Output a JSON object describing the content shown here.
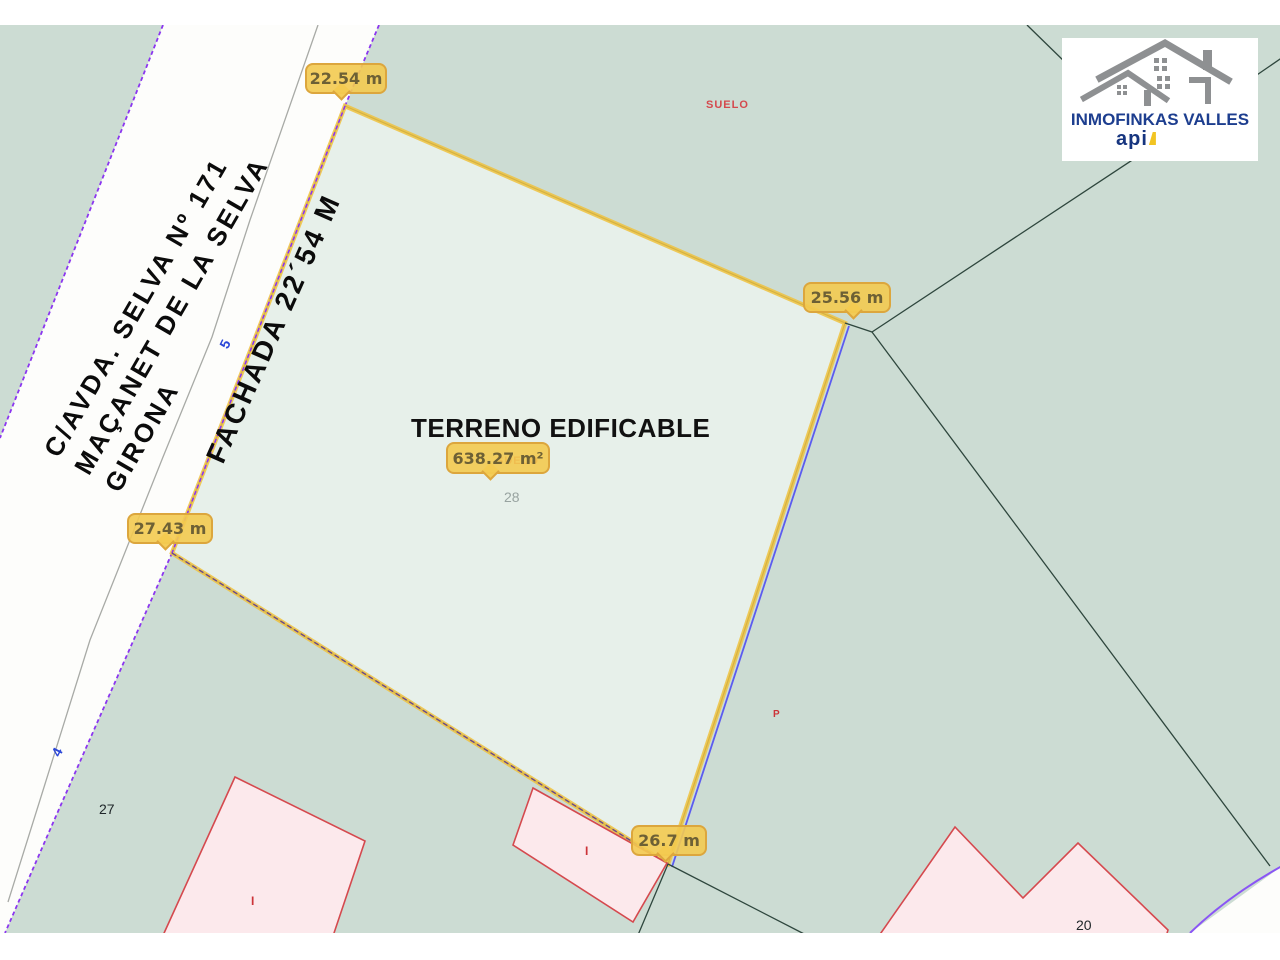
{
  "street": {
    "line1": "C/AVDA. SELVA Nº 171",
    "line2": "MAÇANET DE LA SELVA",
    "line3": "GIRONA"
  },
  "plot": {
    "title": "TERRENO EDIFICABLE",
    "facade_label": "FACHADA 22´54 M",
    "area_label": "638.27 m²",
    "parcel_number": "28"
  },
  "measurements": {
    "top": "22.54 m",
    "right": "25.56 m",
    "left": "27.43 m",
    "bottom": "26.7 m"
  },
  "map_labels": {
    "suelo": "SUELO",
    "suelo_hidden": "SUELO",
    "p_marker": "P",
    "parcel_27": "27",
    "parcel_20": "20",
    "road_number_5": "5",
    "road_number_4": "4",
    "building_marker": "I"
  },
  "logo": {
    "company": "INMOFINKAS VALLES",
    "brand": "api"
  },
  "colors": {
    "map_background": "#CCDCD3",
    "plot_fill": "#E7F0EA",
    "plot_boundary_yellow": "#EEC23E",
    "road_edge_purple": "#8B35F0",
    "boundary_blue": "#5B5BF0",
    "parcel_line": "#2E463D",
    "building_fill": "#FCE9EC",
    "building_stroke": "#D5494E",
    "badge_background": "#F3CA50",
    "badge_border": "#DBA43C",
    "badge_text": "#6D6035",
    "label_red": "#D4494D",
    "road_number_blue": "#2A46D8",
    "logo_blue": "#1D3E8F",
    "logo_gray": "#8E9092"
  }
}
